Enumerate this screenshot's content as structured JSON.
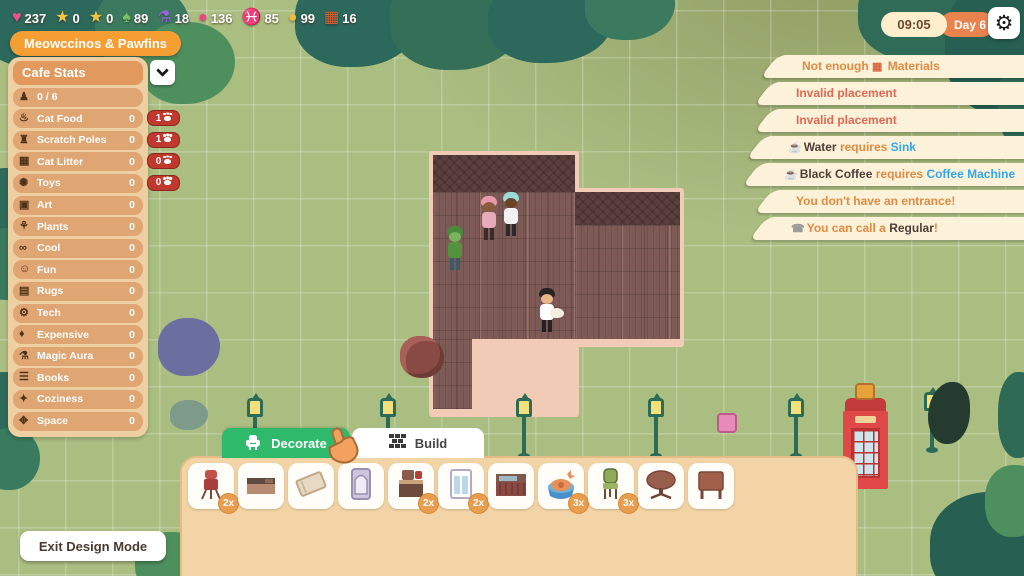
{
  "resources": [
    {
      "icon": "heart-icon",
      "value": "237"
    },
    {
      "icon": "star-icon",
      "value": "0"
    },
    {
      "icon": "star-icon",
      "value": "0"
    },
    {
      "icon": "leaf-icon",
      "value": "89"
    },
    {
      "icon": "potion-icon",
      "value": "18"
    },
    {
      "icon": "gem-icon",
      "value": "136"
    },
    {
      "icon": "fish-icon",
      "value": "85"
    },
    {
      "icon": "coin-icon",
      "value": "99"
    },
    {
      "icon": "materials-icon",
      "value": "16"
    }
  ],
  "cafe_name": "Meowccinos & Pawfins",
  "stats": {
    "title": "Cafe Stats",
    "rows": [
      {
        "icon": "chair-icon",
        "label": "0 / 6",
        "value": ""
      },
      {
        "icon": "cat-food-icon",
        "label": "Cat Food",
        "value": "0",
        "badge": "1"
      },
      {
        "icon": "scratch-poles-icon",
        "label": "Scratch Poles",
        "value": "0",
        "badge": "1"
      },
      {
        "icon": "cat-litter-icon",
        "label": "Cat Litter",
        "value": "0",
        "badge": "0"
      },
      {
        "icon": "toys-icon",
        "label": "Toys",
        "value": "0",
        "badge": "0"
      },
      {
        "icon": "art-icon",
        "label": "Art",
        "value": "0"
      },
      {
        "icon": "plants-icon",
        "label": "Plants",
        "value": "0"
      },
      {
        "icon": "cool-icon",
        "label": "Cool",
        "value": "0"
      },
      {
        "icon": "fun-icon",
        "label": "Fun",
        "value": "0"
      },
      {
        "icon": "rugs-icon",
        "label": "Rugs",
        "value": "0"
      },
      {
        "icon": "tech-icon",
        "label": "Tech",
        "value": "0"
      },
      {
        "icon": "expensive-icon",
        "label": "Expensive",
        "value": "0"
      },
      {
        "icon": "magic-aura-icon",
        "label": "Magic Aura",
        "value": "0"
      },
      {
        "icon": "books-icon",
        "label": "Books",
        "value": "0"
      },
      {
        "icon": "coziness-icon",
        "label": "Coziness",
        "value": "0"
      },
      {
        "icon": "space-icon",
        "label": "Space",
        "value": "0"
      }
    ]
  },
  "notifications": [
    {
      "name": "not-enough-materials",
      "parts": [
        {
          "text": "Not enough ",
          "style": "orange"
        },
        {
          "icon": "materials-icon"
        },
        {
          "text": " Materials",
          "style": "orange"
        }
      ]
    },
    {
      "name": "invalid-placement",
      "parts": [
        {
          "text": "Invalid placement",
          "style": "red"
        }
      ]
    },
    {
      "name": "invalid-placement",
      "parts": [
        {
          "text": "Invalid placement",
          "style": "red"
        }
      ]
    },
    {
      "name": "water-requires-sink",
      "parts": [
        {
          "icon": "drink-icon"
        },
        {
          "text": "Water",
          "style": "dark"
        },
        {
          "text": " requires ",
          "style": "orange"
        },
        {
          "text": "Sink",
          "style": "blue"
        }
      ]
    },
    {
      "name": "coffee-requires-machine",
      "parts": [
        {
          "icon": "coffee-icon"
        },
        {
          "text": "Black Coffee",
          "style": "dark"
        },
        {
          "text": " requires ",
          "style": "orange"
        },
        {
          "text": "Coffee Machine",
          "style": "blue"
        }
      ]
    },
    {
      "name": "no-entrance",
      "parts": [
        {
          "text": "You don't have an entrance!",
          "style": "orange"
        }
      ]
    },
    {
      "name": "call-regular",
      "parts": [
        {
          "icon": "call-icon"
        },
        {
          "text": "You can call a ",
          "style": "orange"
        },
        {
          "text": "Regular",
          "style": "dark"
        },
        {
          "text": "!",
          "style": "orange"
        }
      ]
    }
  ],
  "clock": {
    "time": "09:05",
    "day": "Day 6"
  },
  "tabs": [
    {
      "label": "Decorate",
      "icon": "chair-icon",
      "active": true
    },
    {
      "label": "Build",
      "icon": "bricks-icon",
      "active": false
    }
  ],
  "palette": {
    "items": [
      {
        "icon": "water-cooler-icon",
        "count": "2x"
      },
      {
        "icon": "counter-icon",
        "count": ""
      },
      {
        "icon": "rug-icon",
        "count": ""
      },
      {
        "icon": "door-icon",
        "count": ""
      },
      {
        "icon": "coffee-machine-icon",
        "count": "2x"
      },
      {
        "icon": "window-icon",
        "count": "2x"
      },
      {
        "icon": "bar-counter-icon",
        "count": ""
      },
      {
        "icon": "pet-bowl-icon",
        "count": "3x"
      },
      {
        "icon": "cafe-chair-icon",
        "count": "3x"
      },
      {
        "icon": "round-table-icon",
        "count": ""
      },
      {
        "icon": "square-table-icon",
        "count": ""
      }
    ]
  },
  "exit_button_label": "Exit Design Mode",
  "colors": {
    "accent_orange": "#f59e33",
    "tab_green": "#2fb96a",
    "badge_red": "#c0392e",
    "notification_bg": "#fcf2da",
    "link_blue": "#35a7e8"
  }
}
